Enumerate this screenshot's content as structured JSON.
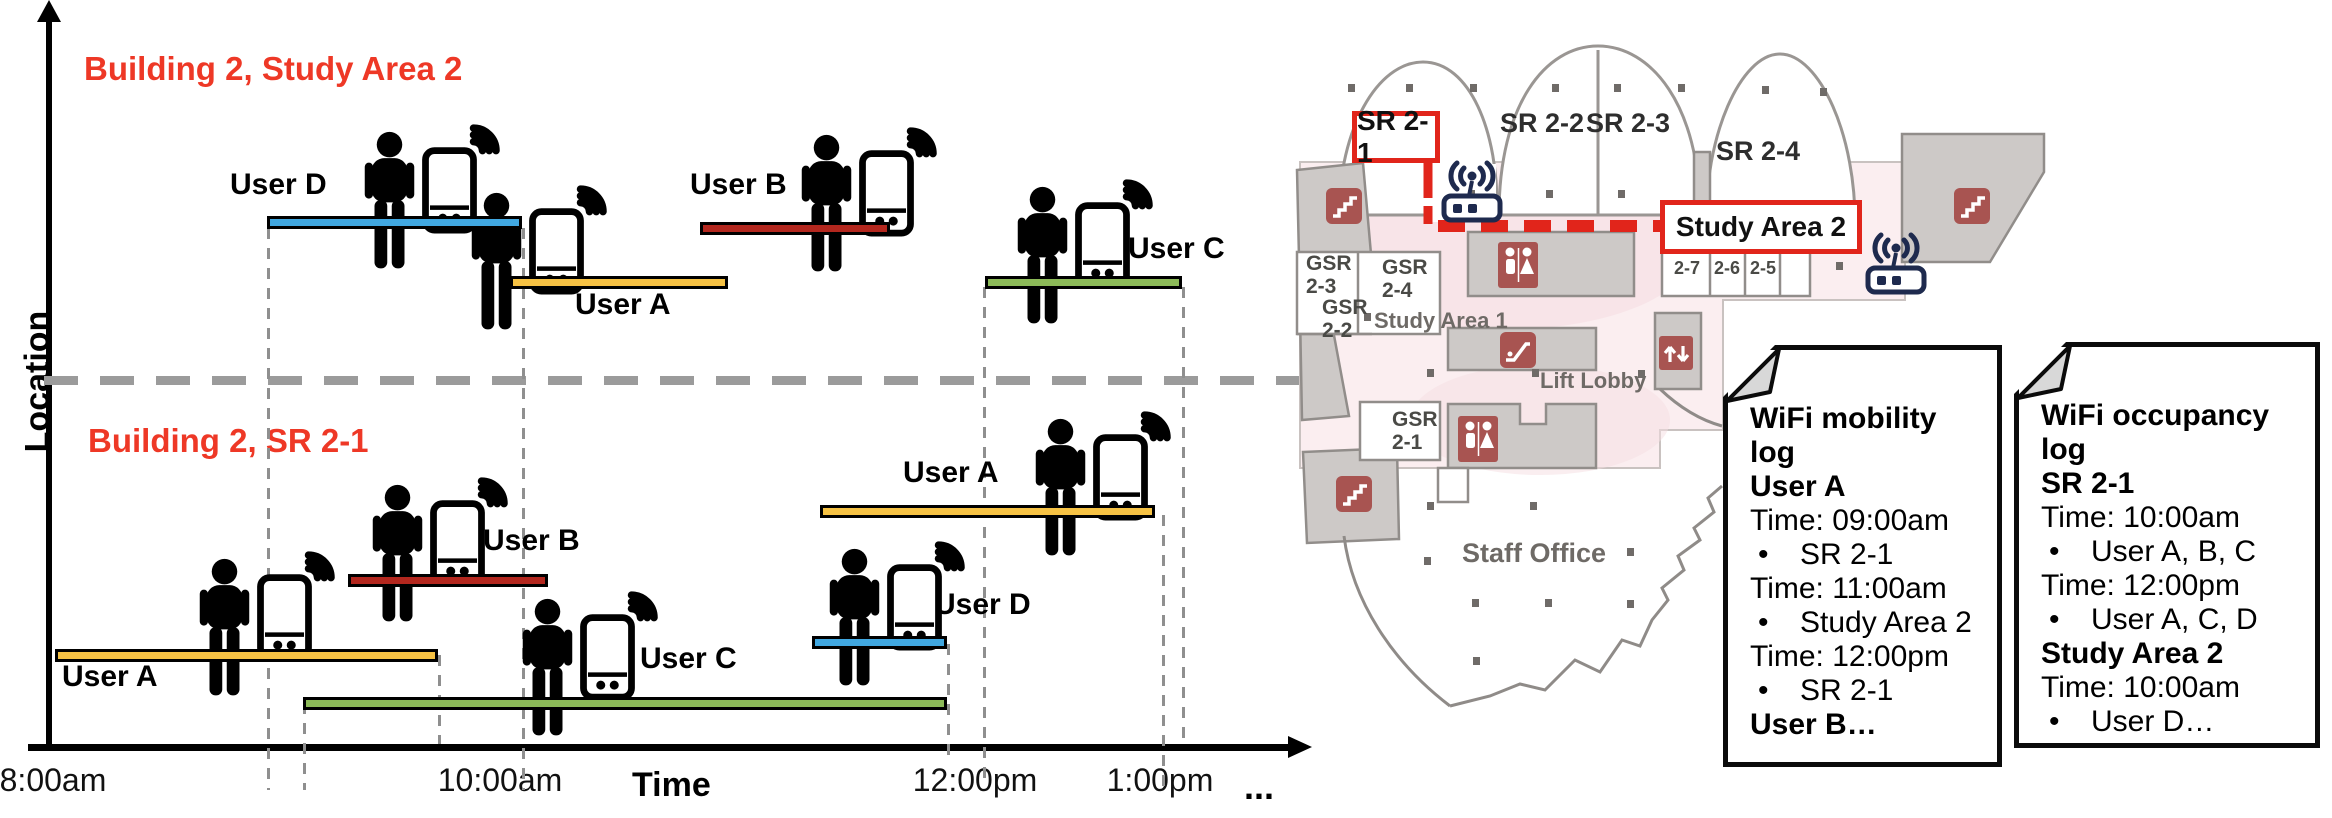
{
  "chart": {
    "y_axis_label": "Location",
    "x_axis_label": "Time",
    "x_ticks": [
      {
        "label": "8:00am",
        "x": -22
      },
      {
        "label": "10:00am",
        "x": 425
      },
      {
        "label": "12:00pm",
        "x": 900
      },
      {
        "label": "1:00pm",
        "x": 1085
      }
    ],
    "ellipsis": "...",
    "sections": [
      {
        "title": "Building 2, Study Area 2",
        "x": 84,
        "y": 50
      },
      {
        "title": "Building 2, SR 2-1",
        "x": 88,
        "y": 422
      }
    ],
    "colors": {
      "title_red": "#ee3826",
      "user_a_yellow": "#f6c244",
      "user_b_red": "#b3271e",
      "user_c_green": "#8cba58",
      "user_d_blue": "#41a8e1"
    },
    "bars": [
      {
        "user": "User D",
        "room": "Study Area 2",
        "x": 267,
        "y": 216,
        "w": 255,
        "h": 13,
        "color": "#41a8e1"
      },
      {
        "user": "User A",
        "room": "Study Area 2",
        "x": 510,
        "y": 276,
        "w": 218,
        "h": 13,
        "color": "#f6c244"
      },
      {
        "user": "User B",
        "room": "Study Area 2",
        "x": 700,
        "y": 222,
        "w": 190,
        "h": 13,
        "color": "#b3271e"
      },
      {
        "user": "User C",
        "room": "Study Area 2",
        "x": 985,
        "y": 276,
        "w": 197,
        "h": 13,
        "color": "#8cba58"
      },
      {
        "user": "User A",
        "room": "SR 2-1",
        "x": 55,
        "y": 649,
        "w": 383,
        "h": 13,
        "color": "#f6c244"
      },
      {
        "user": "User B",
        "room": "SR 2-1",
        "x": 348,
        "y": 574,
        "w": 200,
        "h": 13,
        "color": "#b3271e"
      },
      {
        "user": "User C",
        "room": "SR 2-1",
        "x": 303,
        "y": 697,
        "w": 644,
        "h": 13,
        "color": "#8cba58"
      },
      {
        "user": "User D",
        "room": "SR 2-1",
        "x": 812,
        "y": 636,
        "w": 135,
        "h": 13,
        "color": "#41a8e1"
      },
      {
        "user": "User A",
        "room": "SR 2-1",
        "x": 820,
        "y": 505,
        "w": 335,
        "h": 13,
        "color": "#f6c244"
      }
    ],
    "user_labels": [
      {
        "text": "User D",
        "x": 230,
        "y": 168
      },
      {
        "text": "User A",
        "x": 575,
        "y": 288
      },
      {
        "text": "User B",
        "x": 690,
        "y": 168
      },
      {
        "text": "User C",
        "x": 1128,
        "y": 232
      },
      {
        "text": "User A",
        "x": 62,
        "y": 660
      },
      {
        "text": "User B",
        "x": 483,
        "y": 524
      },
      {
        "text": "User C",
        "x": 640,
        "y": 642
      },
      {
        "text": "User D",
        "x": 934,
        "y": 588
      },
      {
        "text": "User A",
        "x": 903,
        "y": 456
      }
    ],
    "persons": [
      {
        "x": 352,
        "y": 131
      },
      {
        "x": 459,
        "y": 192
      },
      {
        "x": 789,
        "y": 134
      },
      {
        "x": 1005,
        "y": 186
      },
      {
        "x": 187,
        "y": 558
      },
      {
        "x": 360,
        "y": 484
      },
      {
        "x": 510,
        "y": 598
      },
      {
        "x": 817,
        "y": 548
      },
      {
        "x": 1023,
        "y": 418
      }
    ],
    "vlines": [
      {
        "x": 267,
        "y1": 228,
        "y2": 790
      },
      {
        "x": 303,
        "y1": 703,
        "y2": 790
      },
      {
        "x": 438,
        "y1": 655,
        "y2": 744
      },
      {
        "x": 522,
        "y1": 228,
        "y2": 790
      },
      {
        "x": 947,
        "y1": 644,
        "y2": 758
      },
      {
        "x": 983,
        "y1": 287,
        "y2": 783
      },
      {
        "x": 1162,
        "y1": 515,
        "y2": 790
      },
      {
        "x": 1182,
        "y1": 287,
        "y2": 744
      }
    ]
  },
  "floor_plan": {
    "rooms": {
      "sr21": "SR 2-1",
      "sr22": "SR 2-2",
      "sr23": "SR 2-3",
      "sr24": "SR 2-4",
      "study_area_2": "Study Area 2",
      "study_area_1": "Study Area 1",
      "gsr23": "GSR 2-3",
      "gsr24": "GSR 2-4",
      "gsr22": "GSR 2-2",
      "gsr21": "GSR 2-1",
      "lift_lobby": "Lift Lobby",
      "staff_office": "Staff Office",
      "small_rooms": [
        "2-7",
        "2-6",
        "2-5"
      ]
    },
    "colors": {
      "floor_pink": "#fbeef0",
      "wall_gray": "#cdc9c7",
      "icon_maroon": "#a85451",
      "router_navy": "#1e2a4e",
      "highlight_red": "#e1251b"
    },
    "icons": [
      "wifi-router",
      "wifi-router",
      "stairs",
      "stairs",
      "stairs",
      "restroom",
      "restroom",
      "escalator",
      "lift"
    ]
  },
  "cards": {
    "bullet": "•",
    "mobility": {
      "lines": [
        {
          "style": "bold",
          "text": "WiFi mobility log"
        },
        {
          "style": "bold",
          "text": "User A"
        },
        {
          "style": "plain",
          "text": "Time: 09:00am"
        },
        {
          "style": "bullet",
          "text": "SR 2-1"
        },
        {
          "style": "plain",
          "text": "Time: 11:00am"
        },
        {
          "style": "bullet",
          "text": "Study Area 2"
        },
        {
          "style": "plain",
          "text": "Time: 12:00pm"
        },
        {
          "style": "bullet",
          "text": "SR 2-1"
        },
        {
          "style": "bold",
          "text": "User B…"
        }
      ]
    },
    "occupancy": {
      "lines": [
        {
          "style": "bold",
          "text": "WiFi occupancy log"
        },
        {
          "style": "bold",
          "text": "SR 2-1"
        },
        {
          "style": "plain",
          "text": "Time: 10:00am"
        },
        {
          "style": "bullet",
          "text": "User A, B, C"
        },
        {
          "style": "plain",
          "text": "Time: 12:00pm"
        },
        {
          "style": "bullet",
          "text": "User A, C, D"
        },
        {
          "style": "bold",
          "text": "Study Area 2"
        },
        {
          "style": "plain",
          "text": "Time: 10:00am"
        },
        {
          "style": "bullet",
          "text": "User D…"
        }
      ]
    }
  }
}
